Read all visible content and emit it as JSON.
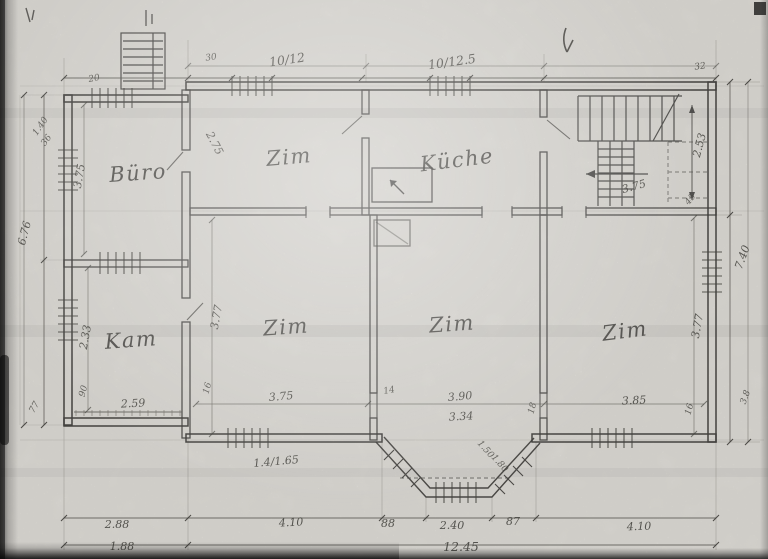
{
  "plan": {
    "kind": "scanned hand-drawn floor plan",
    "colors": {
      "paper": "#e8e6e1",
      "ink": "#3b3a37",
      "dim_ink": "#44433e"
    },
    "rooms": {
      "buero": "Büro",
      "zim_top": "Zim",
      "kueche": "Küche",
      "kam": "Kam",
      "zim_sw": "Zim",
      "zim_s": "Zim",
      "zim_se": "Zim"
    },
    "dims": {
      "top_porch": "20",
      "top_left": "30",
      "top_win1": "10/12",
      "top_win2": "10/12.5",
      "top_right": "32",
      "left_small_a": "1.40",
      "left_small_b": "36",
      "left_total": "6.76",
      "buero_h": "3.75",
      "kam_h": "2.33",
      "kam_w": "2.59",
      "left_bottom": "77",
      "zim_top_diag": "2.75",
      "sw_h": "3.77",
      "sw_w": "3.75",
      "sw_small": "16",
      "sw_door": "1.4/1.65",
      "s_w1": "3.90",
      "s_w2": "3.34",
      "s_small": "14",
      "s_small2": "18",
      "se_w": "3.85",
      "se_h": "3.77",
      "se_small": "16",
      "right_total": "7.40",
      "right_bottom": "3.8",
      "stairs_h": "2.53",
      "stairs_w": "3.75",
      "stairs_small": "45",
      "bay_diag1": "1.50",
      "bay_diag2": "1.80",
      "bay_left": "88",
      "bay_mid": "2.40",
      "bay_right": "87",
      "bottom_sw": "4.10",
      "bottom_se": "4.10",
      "bottom_left1": "2.88",
      "bottom_left2": "1.88",
      "total_w": "12.45",
      "kam_small": "90"
    }
  }
}
